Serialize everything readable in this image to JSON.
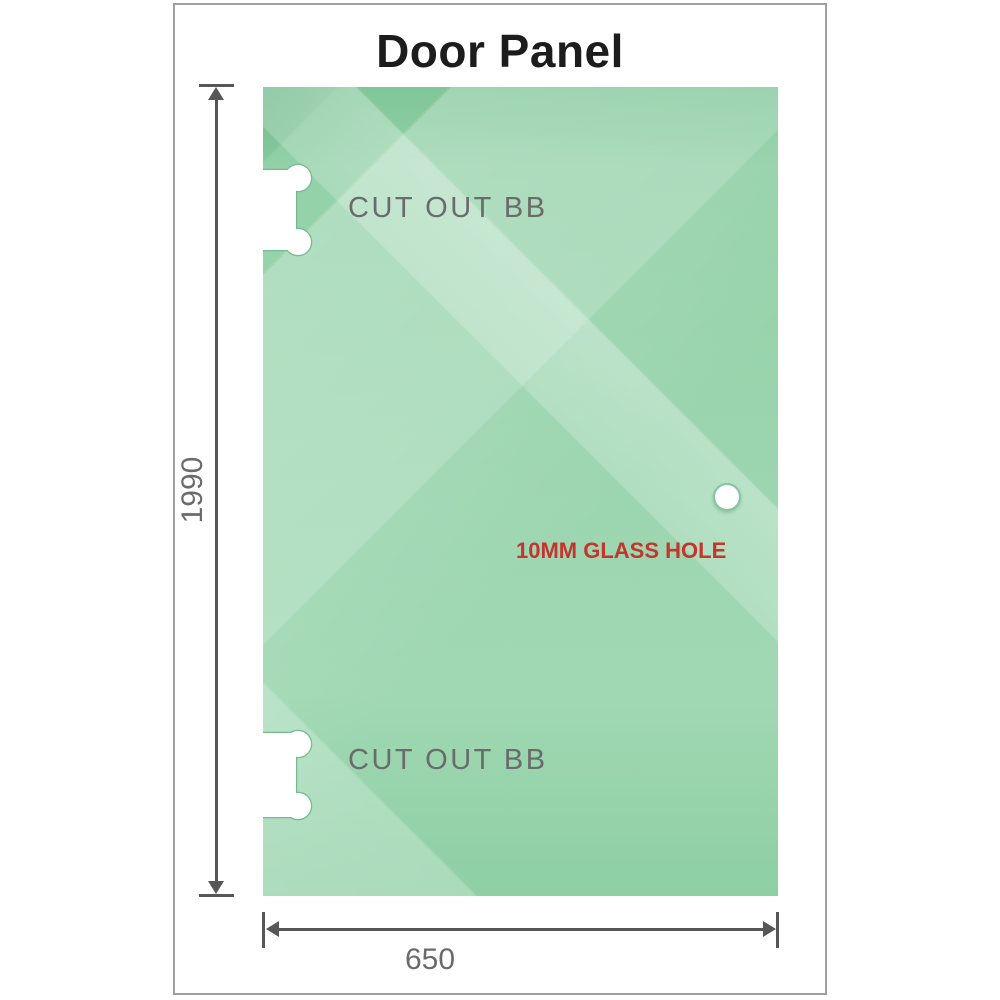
{
  "title": "Door Panel",
  "panel": {
    "height_label": "1990",
    "width_label": "650",
    "cutout_top_label": "CUT OUT BB",
    "cutout_bottom_label": "CUT OUT BB",
    "hole_label": "10MM GLASS HOLE"
  },
  "colors": {
    "glass_base": "#9bd5af",
    "glass_dark": "#7fc698",
    "glass_light": "#bce4ca",
    "dimension": "#565656",
    "label_gray": "#6b6b6b",
    "hole_label_red": "#c2362e",
    "title_black": "#1c1c1c",
    "frame_border": "#a0a0a0",
    "cutout_outline": "#78ba90"
  }
}
